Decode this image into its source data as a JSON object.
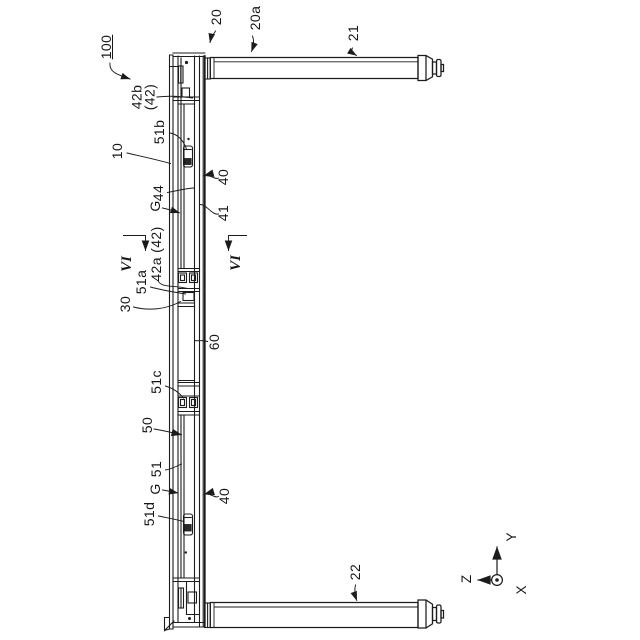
{
  "figure": {
    "figure_number": "100",
    "drawing_type": "patent assembly drawing, side view with section markers",
    "labels": {
      "n100": "100",
      "n20": "20",
      "n20a": "20a",
      "n21": "21",
      "n22": "22",
      "n42b_l1": "42b",
      "n42b_l2": "(42)",
      "n51b": "51b",
      "n10": "10",
      "n40_top": "40",
      "n44": "44",
      "nG_top": "G",
      "n41": "41",
      "nVI_left": "VI",
      "nVI_right": "VI",
      "n42a": "42a (42)",
      "n51a": "51a",
      "n30": "30",
      "n60": "60",
      "n51c": "51c",
      "n50": "50",
      "n51": "51",
      "nG_bottom": "G",
      "n51d": "51d",
      "n40_bottom": "40"
    },
    "axes": {
      "y": "Y",
      "z": "Z",
      "x": "X"
    },
    "colors": {
      "line": "#1c1c1c",
      "background": "#ffffff"
    }
  }
}
